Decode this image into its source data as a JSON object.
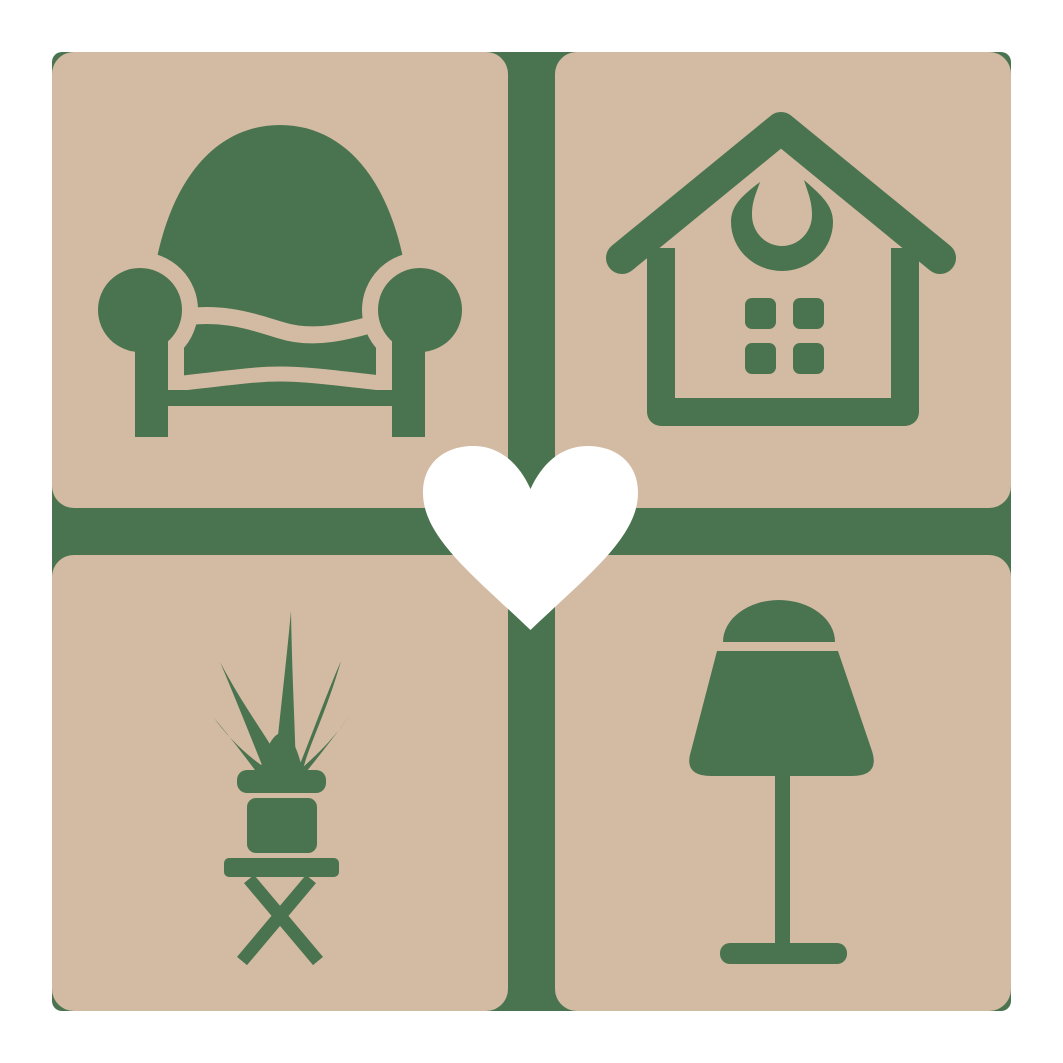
{
  "logo": {
    "name": "home-decor-love-logo",
    "alt_text": "Four beige rounded tiles with green home furnishing icons - armchair, house, potted plant and table lamp - joined by a green cross, with a white heart at the center",
    "grid": {
      "rows": 2,
      "cols": 2
    },
    "tiles": [
      {
        "id": "armchair",
        "icon": "armchair-icon",
        "position": "top-left"
      },
      {
        "id": "house",
        "icon": "house-icon",
        "position": "top-right"
      },
      {
        "id": "plant",
        "icon": "potted-plant-icon",
        "position": "bottom-left"
      },
      {
        "id": "lamp",
        "icon": "table-lamp-icon",
        "position": "bottom-right"
      }
    ],
    "center_symbol": "heart-icon"
  },
  "colors": {
    "green": "#4a744f",
    "beige": "#d3bba3",
    "white": "#ffffff"
  }
}
